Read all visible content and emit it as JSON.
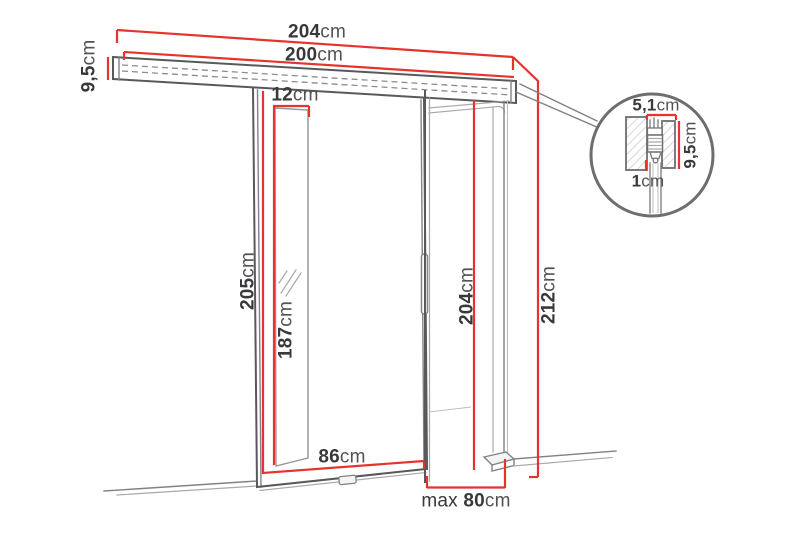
{
  "diagram": {
    "title": "Sliding door dimension diagram",
    "unit_system": "cm"
  },
  "colors": {
    "dim-red": "#e5332d",
    "line-dark": "#58595b",
    "line-mid": "#808285",
    "line-light": "#a7a9ac",
    "text-dark": "#39393b",
    "unit-gray": "#515254",
    "bg": "#ffffff"
  },
  "dimensions": {
    "rail_outer_width": {
      "value": "204",
      "unit": "cm"
    },
    "rail_inner_width": {
      "value": "200",
      "unit": "cm"
    },
    "rail_height": {
      "value": "9,5",
      "unit": "cm"
    },
    "mirror_strip_width": {
      "value": "12",
      "unit": "cm"
    },
    "door_height": {
      "value": "205",
      "unit": "cm"
    },
    "mirror_height": {
      "value": "187",
      "unit": "cm"
    },
    "door_width": {
      "value": "86",
      "unit": "cm"
    },
    "opening_height": {
      "value": "204",
      "unit": "cm"
    },
    "total_height": {
      "value": "212",
      "unit": "cm"
    },
    "max_opening_width": {
      "prefix": "max ",
      "value": "80",
      "unit": "cm"
    },
    "detail_top_width": {
      "value": "5,1",
      "unit": "cm"
    },
    "detail_rail_height": {
      "value": "9,5",
      "unit": "cm"
    },
    "detail_offset": {
      "value": "1",
      "unit": "cm"
    }
  }
}
